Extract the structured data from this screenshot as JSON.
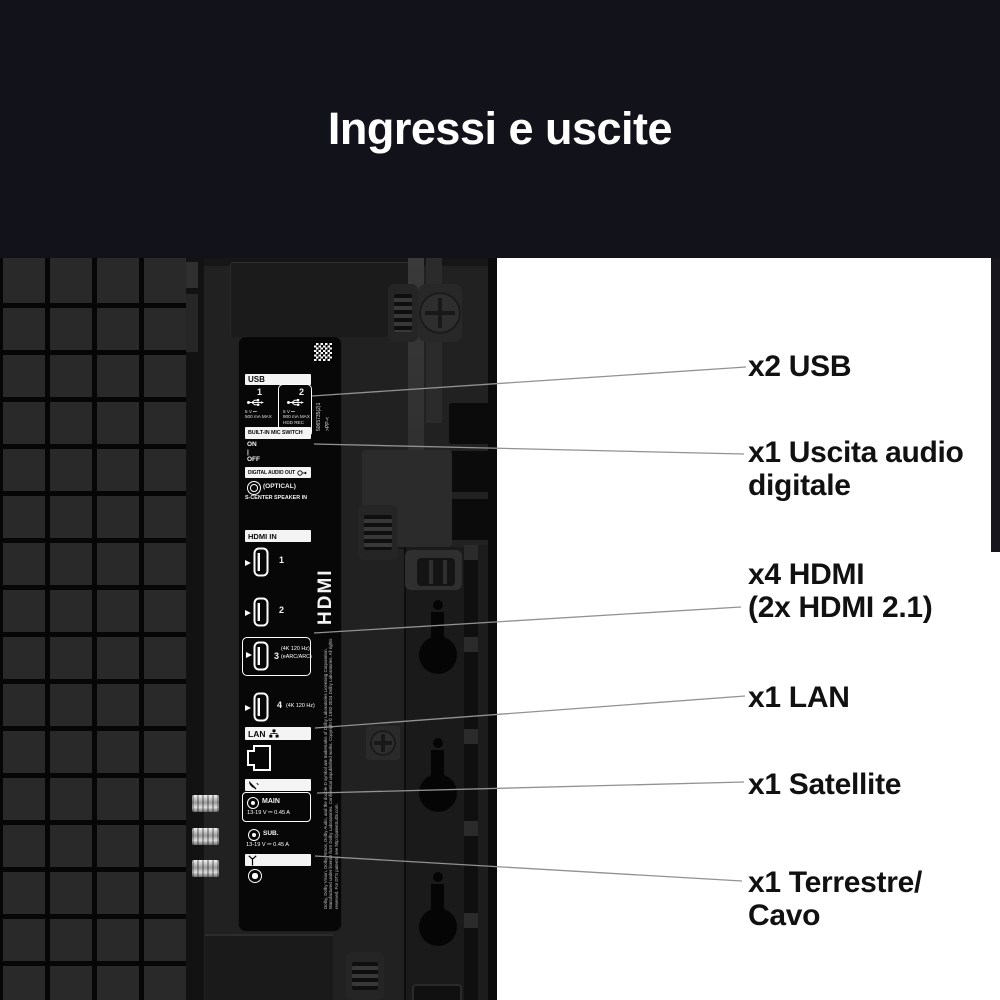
{
  "header": {
    "title": "Ingressi e uscite"
  },
  "panel": {
    "serial": "5065735(2)1",
    "serial_suffix": ">PP-<",
    "usb": {
      "header": "USB",
      "port1": {
        "num": "1",
        "spec": "5 V ⎓\n500 mA MAX"
      },
      "port2": {
        "num": "2",
        "spec": "5 V ⎓\n900 mA MAX\nHDD REC"
      }
    },
    "mic": {
      "header": "BUILT-IN MIC SWITCH",
      "switch": "ON\n|\nOFF"
    },
    "digital_audio": {
      "header": "DIGITAL AUDIO OUT",
      "optical": "(OPTICAL)",
      "speaker": "S-CENTER  SPEAKER IN"
    },
    "hdmi": {
      "header": "HDMI IN",
      "vertical_label": "HDMI",
      "port1": "1",
      "port2": "2",
      "port3": {
        "num": "3",
        "spec": "(4K 120 Hz)\n(eARC/ARC)"
      },
      "port4": {
        "num": "4",
        "spec": "(4K 120 Hz)"
      }
    },
    "lan": {
      "header": "LAN"
    },
    "power": {
      "main": {
        "label": "MAIN",
        "spec": "13-19 V ⎓  0.45 A"
      },
      "sub": {
        "label": "SUB.",
        "spec": "13-19 V ⎓  0.45 A"
      }
    },
    "legal": "Dolby, Dolby Vision, Dolby Atmos, Dolby Audio, and the double-D symbol are trademarks of Dolby Laboratories Licensing Corporation. Manufactured under license from Dolby Laboratories. Confidential unpublished works. Copyright © 1992-2024 Dolby Laboratories. All rights reserved. For DTS patents, see http://patents.dts.com."
  },
  "callouts": [
    {
      "lines": [
        "x2 USB",
        ""
      ]
    },
    {
      "lines": [
        "x1 Uscita audio",
        "digitale"
      ]
    },
    {
      "lines": [
        "x4 HDMI",
        "(2x HDMI 2.1)"
      ]
    },
    {
      "lines": [
        "x1 LAN",
        ""
      ]
    },
    {
      "lines": [
        "x1 Satellite",
        ""
      ]
    },
    {
      "lines": [
        "x1 Terrestre/",
        "Cavo"
      ]
    }
  ],
  "colors": {
    "header_bg": "#12121b",
    "panel_bg": "#070707",
    "label_bar": "#f4f4f4",
    "lead_line": "#929292",
    "callout_text": "#111111"
  },
  "icons": {
    "qr_code": "qr-checker",
    "usb_port": "usb-trident",
    "optical_out": "double-ring",
    "audio_out_arrow": "circle-arrow-right",
    "hdmi_plug": "hdmi-connector-outline",
    "input_arrow": "right-triangle",
    "lan_port": "rj45-outline",
    "lan_nodes": "network-nodes",
    "satellite": "satellite-dish",
    "antenna": "antenna-t",
    "power_connector": "ring-dot",
    "screw": "phillips-screw",
    "wall_mount": "keyhole-slot"
  }
}
